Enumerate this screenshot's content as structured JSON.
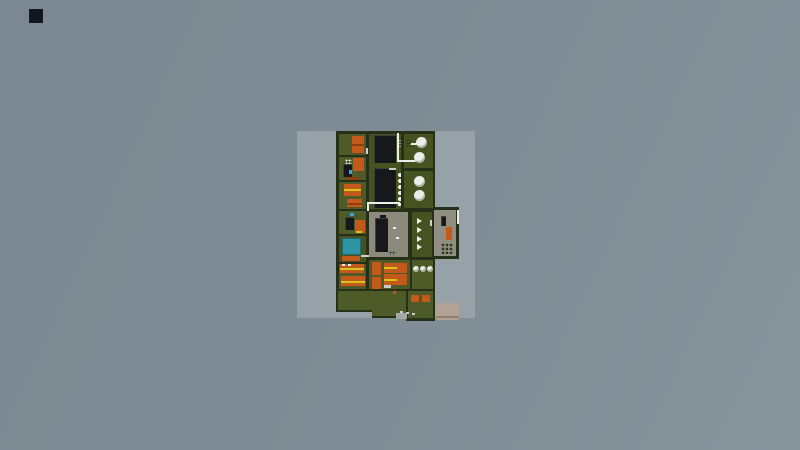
{
  "scene": {
    "description": "top-down pixel factory base map centered on light ground patch",
    "viewport": {
      "width": 800,
      "height": 450
    },
    "palette": {
      "patch": "#97a1a8",
      "marker": "#12161d",
      "wall": "#263018",
      "floor": "#4e5a28",
      "floorDark": "#46521f",
      "floorGray": "#8b8a7d",
      "floorAnnex": "#8f8e81",
      "orange": "#c35a1c",
      "orangeDark": "#8f3e10",
      "yellow": "#d9c41e",
      "black": "#17181b",
      "white": "#ecede9",
      "lightgray": "#c8ccc2",
      "doorLight": "#cfd2c8",
      "speckDark": "#2e3a1c",
      "teal": "#2f93a3",
      "tealDark": "#1d6a78",
      "blue": "#3aa7e0",
      "tan": "#b2a294",
      "tanDark": "#8e8172",
      "padGray": "#a3aaa5"
    },
    "elements": [
      {
        "n": "ground-patch",
        "t": "r",
        "x": 297,
        "y": 131,
        "w": 178,
        "h": 187,
        "c": "patch",
        "i": false
      },
      {
        "n": "corner-dark-square",
        "t": "r",
        "x": 29,
        "y": 9,
        "w": 14,
        "h": 14,
        "c": "marker",
        "i": false
      },
      {
        "n": "main-building-shell",
        "t": "r",
        "x": 336,
        "y": 131,
        "w": 99,
        "h": 162,
        "c": "wall",
        "i": false
      },
      {
        "n": "annex-shell",
        "t": "r",
        "x": 431,
        "y": 207,
        "w": 28,
        "h": 52,
        "c": "wall",
        "i": false
      },
      {
        "n": "yard-shell-a",
        "t": "r",
        "x": 336,
        "y": 289,
        "w": 38,
        "h": 23,
        "c": "wall",
        "i": false
      },
      {
        "n": "yard-shell-b",
        "t": "r",
        "x": 372,
        "y": 289,
        "w": 36,
        "h": 29,
        "c": "wall",
        "i": false
      },
      {
        "n": "yard-shell-c",
        "t": "r",
        "x": 406,
        "y": 289,
        "w": 29,
        "h": 32,
        "c": "wall",
        "i": false
      },
      {
        "n": "room-storage-1",
        "t": "r",
        "x": 339,
        "y": 134,
        "w": 27,
        "h": 21,
        "c": "floor",
        "i": true
      },
      {
        "n": "room-storage-2",
        "t": "r",
        "x": 339,
        "y": 157,
        "w": 27,
        "h": 23,
        "c": "floor",
        "i": true
      },
      {
        "n": "room-workshop-1",
        "t": "r",
        "x": 339,
        "y": 182,
        "w": 27,
        "h": 27,
        "c": "floor",
        "i": true
      },
      {
        "n": "room-workshop-2",
        "t": "r",
        "x": 339,
        "y": 211,
        "w": 27,
        "h": 23,
        "c": "floor",
        "i": true
      },
      {
        "n": "room-pool",
        "t": "r",
        "x": 339,
        "y": 236,
        "w": 27,
        "h": 26,
        "c": "floorDark",
        "i": true
      },
      {
        "n": "room-dorm-left",
        "t": "r",
        "x": 339,
        "y": 264,
        "w": 27,
        "h": 25,
        "c": "floor",
        "i": true
      },
      {
        "n": "hall-machines",
        "t": "r",
        "x": 369,
        "y": 134,
        "w": 32,
        "h": 75,
        "c": "floorDark",
        "i": true
      },
      {
        "n": "room-gray-hall",
        "t": "r",
        "x": 369,
        "y": 212,
        "w": 39,
        "h": 45,
        "c": "floorGray",
        "i": true
      },
      {
        "n": "room-conveyor",
        "t": "r",
        "x": 412,
        "y": 212,
        "w": 20,
        "h": 45,
        "c": "floorDark",
        "i": true
      },
      {
        "n": "room-dorm-mid",
        "t": "r",
        "x": 369,
        "y": 260,
        "w": 41,
        "h": 29,
        "c": "floor",
        "i": true
      },
      {
        "n": "room-tanks-1",
        "t": "r",
        "x": 404,
        "y": 134,
        "w": 29,
        "h": 34,
        "c": "floorDark",
        "i": true
      },
      {
        "n": "room-tanks-2",
        "t": "r",
        "x": 404,
        "y": 171,
        "w": 29,
        "h": 37,
        "c": "floorDark",
        "i": true
      },
      {
        "n": "room-tanks-3",
        "t": "r",
        "x": 412,
        "y": 260,
        "w": 21,
        "h": 29,
        "c": "floor",
        "i": true
      },
      {
        "n": "annex-floor",
        "t": "r",
        "x": 434,
        "y": 210,
        "w": 22,
        "h": 46,
        "c": "floorAnnex",
        "i": true
      },
      {
        "n": "yard-floor-a",
        "t": "r",
        "x": 338,
        "y": 291,
        "w": 36,
        "h": 19,
        "c": "floor",
        "i": true
      },
      {
        "n": "yard-floor-b",
        "t": "r",
        "x": 372,
        "y": 291,
        "w": 34,
        "h": 25,
        "c": "floor",
        "i": true
      },
      {
        "n": "yard-floor-c",
        "t": "r",
        "x": 408,
        "y": 291,
        "w": 25,
        "h": 27,
        "c": "floor",
        "i": true
      },
      {
        "n": "machine-orange-1",
        "t": "r",
        "x": 352,
        "y": 136,
        "w": 12,
        "h": 17,
        "c": "orange",
        "i": true
      },
      {
        "n": "machine-orange-1-line",
        "t": "r",
        "x": 352,
        "y": 144,
        "w": 12,
        "h": 2,
        "c": "orangeDark",
        "i": false
      },
      {
        "n": "crate-dots-white",
        "t": "d",
        "x": 345,
        "y": 159,
        "w": 7,
        "h": 8,
        "c": "white",
        "g": 3,
        "i": false
      },
      {
        "n": "machine-orange-2",
        "t": "r",
        "x": 353,
        "y": 158,
        "w": 11,
        "h": 13,
        "c": "orange",
        "i": true
      },
      {
        "n": "machine-dark-1",
        "t": "r",
        "x": 343,
        "y": 164,
        "w": 9,
        "h": 13,
        "c": "black",
        "cls": "mach",
        "i": true
      },
      {
        "n": "indicator-blue-1",
        "t": "r",
        "x": 349,
        "y": 170,
        "w": 3,
        "h": 4,
        "c": "blue",
        "i": false
      },
      {
        "n": "shelf-orange-1",
        "t": "r",
        "x": 348,
        "y": 177,
        "w": 12,
        "h": 3,
        "c": "orangeDark",
        "i": false
      },
      {
        "n": "machine-orange-3",
        "t": "r",
        "x": 344,
        "y": 184,
        "w": 17,
        "h": 12,
        "c": "orange",
        "i": true
      },
      {
        "n": "machine-orange-3-line",
        "t": "r",
        "x": 344,
        "y": 189,
        "w": 17,
        "h": 2,
        "c": "yellow",
        "i": false
      },
      {
        "n": "machine-orange-4",
        "t": "r",
        "x": 347,
        "y": 199,
        "w": 15,
        "h": 8,
        "c": "orange",
        "i": true
      },
      {
        "n": "machine-orange-4-line",
        "t": "r",
        "x": 347,
        "y": 203,
        "w": 15,
        "h": 2,
        "c": "orangeDark",
        "i": false
      },
      {
        "n": "indicator-blue-2",
        "t": "r",
        "x": 350,
        "y": 213,
        "w": 4,
        "h": 3,
        "c": "blue",
        "i": false
      },
      {
        "n": "machine-dark-2",
        "t": "r",
        "x": 345,
        "y": 217,
        "w": 9,
        "h": 13,
        "c": "black",
        "cls": "mach",
        "i": true
      },
      {
        "n": "machine-orange-5",
        "t": "r",
        "x": 355,
        "y": 220,
        "w": 10,
        "h": 13,
        "c": "orange",
        "i": true
      },
      {
        "n": "dash-yellow",
        "t": "r",
        "x": 356,
        "y": 231,
        "w": 6,
        "h": 2,
        "c": "yellow",
        "i": false
      },
      {
        "n": "water-pool",
        "t": "r",
        "x": 342,
        "y": 238,
        "w": 19,
        "h": 17,
        "c": "teal",
        "bd": "tealDark",
        "i": true
      },
      {
        "n": "shelf-orange-2",
        "t": "r",
        "x": 342,
        "y": 256,
        "w": 18,
        "h": 5,
        "c": "orange",
        "i": false
      },
      {
        "n": "bed-left-1",
        "t": "r",
        "x": 340,
        "y": 264,
        "w": 24,
        "h": 9,
        "c": "orange",
        "i": true
      },
      {
        "n": "bed-left-1-line",
        "t": "r",
        "x": 340,
        "y": 268,
        "w": 24,
        "h": 2,
        "c": "yellow",
        "i": false
      },
      {
        "n": "pillow-1",
        "t": "r",
        "x": 342,
        "y": 264,
        "w": 3,
        "h": 2,
        "c": "white",
        "i": false
      },
      {
        "n": "pillow-2",
        "t": "r",
        "x": 348,
        "y": 264,
        "w": 3,
        "h": 2,
        "c": "white",
        "i": false
      },
      {
        "n": "bed-left-2",
        "t": "r",
        "x": 341,
        "y": 276,
        "w": 24,
        "h": 10,
        "c": "orange",
        "i": true
      },
      {
        "n": "bed-left-2-line",
        "t": "r",
        "x": 341,
        "y": 281,
        "w": 24,
        "h": 2,
        "c": "yellow",
        "i": false
      },
      {
        "n": "machine-black-a",
        "t": "r",
        "x": 374,
        "y": 135,
        "w": 22,
        "h": 28,
        "c": "black",
        "cls": "mach",
        "i": true
      },
      {
        "n": "machine-black-b",
        "t": "r",
        "x": 374,
        "y": 168,
        "w": 22,
        "h": 40,
        "c": "black",
        "cls": "mach",
        "i": true
      },
      {
        "n": "machine-b-dash",
        "t": "r",
        "x": 389,
        "y": 168,
        "w": 7,
        "h": 2,
        "c": "lightgray",
        "i": false
      },
      {
        "n": "gauge-dots-1",
        "t": "d",
        "x": 397,
        "y": 139,
        "w": 4,
        "h": 10,
        "c": "white",
        "g": 3,
        "i": false
      },
      {
        "n": "gauge-dots-2",
        "t": "d",
        "x": 397,
        "y": 172,
        "w": 4,
        "h": 34,
        "c": "white",
        "g": 6,
        "i": false
      },
      {
        "n": "pipe-main-vertical",
        "t": "r",
        "x": 397,
        "y": 133,
        "w": 2,
        "h": 29,
        "c": "white",
        "i": false
      },
      {
        "n": "pipe-main-horizontal",
        "t": "r",
        "x": 397,
        "y": 160,
        "w": 21,
        "h": 2,
        "c": "white",
        "i": false
      },
      {
        "n": "pipe-tick",
        "t": "r",
        "x": 410,
        "y": 143,
        "w": 7,
        "h": 2,
        "c": "white",
        "i": false
      },
      {
        "n": "pipe-l-horizontal",
        "t": "r",
        "x": 367,
        "y": 202,
        "w": 33,
        "h": 2,
        "c": "white",
        "i": false
      },
      {
        "n": "pipe-l-vertical",
        "t": "r",
        "x": 367,
        "y": 202,
        "w": 2,
        "h": 9,
        "c": "white",
        "i": false
      },
      {
        "n": "machine-black-c",
        "t": "r",
        "x": 375,
        "y": 218,
        "w": 13,
        "h": 34,
        "c": "black",
        "cls": "mach",
        "i": true
      },
      {
        "n": "machine-c-cap",
        "t": "r",
        "x": 380,
        "y": 215,
        "w": 6,
        "h": 3,
        "c": "black",
        "i": false
      },
      {
        "n": "speck-white-1",
        "t": "r",
        "x": 393,
        "y": 227,
        "w": 3,
        "h": 2,
        "c": "white",
        "i": false
      },
      {
        "n": "speck-white-2",
        "t": "r",
        "x": 396,
        "y": 237,
        "w": 3,
        "h": 2,
        "c": "white",
        "i": false
      },
      {
        "n": "speck-dark-rows",
        "t": "d",
        "x": 389,
        "y": 251,
        "w": 7,
        "h": 4,
        "c": "speckDark",
        "g": 3,
        "i": false
      },
      {
        "n": "conveyor-arrow-1",
        "t": "a",
        "x": 417,
        "y": 218,
        "w": 5,
        "h": 6,
        "c": "white",
        "i": false
      },
      {
        "n": "conveyor-arrow-2",
        "t": "a",
        "x": 417,
        "y": 227,
        "w": 5,
        "h": 6,
        "c": "white",
        "i": false
      },
      {
        "n": "conveyor-arrow-3",
        "t": "a",
        "x": 417,
        "y": 236,
        "w": 5,
        "h": 6,
        "c": "white",
        "i": false
      },
      {
        "n": "conveyor-arrow-4",
        "t": "a",
        "x": 417,
        "y": 244,
        "w": 5,
        "h": 6,
        "c": "white",
        "i": false
      },
      {
        "n": "tank-1",
        "t": "c",
        "x": 416,
        "y": 137,
        "w": 11,
        "c": "white",
        "i": true
      },
      {
        "n": "tank-2",
        "t": "c",
        "x": 414,
        "y": 152,
        "w": 11,
        "c": "white",
        "i": true
      },
      {
        "n": "tank-3",
        "t": "c",
        "x": 414,
        "y": 176,
        "w": 11,
        "c": "white",
        "i": true
      },
      {
        "n": "tank-4",
        "t": "c",
        "x": 414,
        "y": 190,
        "w": 11,
        "c": "white",
        "i": true
      },
      {
        "n": "crate-dots-dark",
        "t": "d",
        "x": 406,
        "y": 139,
        "w": 5,
        "h": 8,
        "c": "speckDark",
        "g": 3,
        "i": false
      },
      {
        "n": "tank-small-1",
        "t": "c",
        "x": 413,
        "y": 266,
        "w": 6,
        "c": "white",
        "i": true
      },
      {
        "n": "tank-small-2",
        "t": "c",
        "x": 420,
        "y": 266,
        "w": 6,
        "c": "white",
        "i": true
      },
      {
        "n": "tank-small-3",
        "t": "c",
        "x": 427,
        "y": 266,
        "w": 6,
        "c": "white",
        "i": true
      },
      {
        "n": "bed-mid-vertical-1",
        "t": "r",
        "x": 372,
        "y": 262,
        "w": 9,
        "h": 13,
        "c": "orange",
        "i": true
      },
      {
        "n": "bed-mid-1",
        "t": "r",
        "x": 384,
        "y": 263,
        "w": 23,
        "h": 10,
        "c": "orange",
        "i": true
      },
      {
        "n": "bed-mid-1-line",
        "t": "r",
        "x": 384,
        "y": 267,
        "w": 13,
        "h": 2,
        "c": "yellow",
        "i": false
      },
      {
        "n": "bed-mid-vertical-2",
        "t": "r",
        "x": 372,
        "y": 277,
        "w": 9,
        "h": 12,
        "c": "orange",
        "i": true
      },
      {
        "n": "bed-mid-2",
        "t": "r",
        "x": 384,
        "y": 274,
        "w": 23,
        "h": 11,
        "c": "orange",
        "i": true
      },
      {
        "n": "bed-mid-2-line",
        "t": "r",
        "x": 384,
        "y": 279,
        "w": 13,
        "h": 2,
        "c": "yellow",
        "i": false
      },
      {
        "n": "locker-white",
        "t": "r",
        "x": 384,
        "y": 285,
        "w": 7,
        "h": 3,
        "c": "lightgray",
        "i": false
      },
      {
        "n": "annex-item-dark",
        "t": "r",
        "x": 441,
        "y": 216,
        "w": 5,
        "h": 10,
        "c": "black",
        "cls": "mach",
        "i": true
      },
      {
        "n": "annex-item-orange",
        "t": "r",
        "x": 446,
        "y": 227,
        "w": 6,
        "h": 13,
        "c": "orange",
        "i": true
      },
      {
        "n": "annex-pallet-dots",
        "t": "d",
        "x": 441,
        "y": 243,
        "w": 12,
        "h": 11,
        "c": "speckDark",
        "g": 4,
        "i": false
      },
      {
        "n": "annex-pipe",
        "t": "r",
        "x": 457,
        "y": 210,
        "w": 2,
        "h": 14,
        "c": "white",
        "i": false
      },
      {
        "n": "annex-door",
        "t": "r",
        "x": 430,
        "y": 220,
        "w": 2,
        "h": 6,
        "c": "doorLight",
        "i": false
      },
      {
        "n": "door-dash-1",
        "t": "r",
        "x": 366,
        "y": 148,
        "w": 2,
        "h": 6,
        "c": "doorLight",
        "i": false
      },
      {
        "n": "door-dash-2",
        "t": "r",
        "x": 361,
        "y": 255,
        "w": 8,
        "h": 2,
        "c": "doorLight",
        "i": false
      },
      {
        "n": "yard-orange-1",
        "t": "r",
        "x": 411,
        "y": 295,
        "w": 8,
        "h": 7,
        "c": "orange",
        "i": true
      },
      {
        "n": "yard-orange-2",
        "t": "r",
        "x": 422,
        "y": 295,
        "w": 8,
        "h": 7,
        "c": "orange",
        "i": true
      },
      {
        "n": "yard-orange-dot",
        "t": "r",
        "x": 393,
        "y": 291,
        "w": 3,
        "h": 3,
        "c": "orange",
        "i": false
      },
      {
        "n": "path-speck-1",
        "t": "r",
        "x": 400,
        "y": 311,
        "w": 3,
        "h": 2,
        "c": "lightgray",
        "i": false
      },
      {
        "n": "path-speck-2",
        "t": "r",
        "x": 406,
        "y": 312,
        "w": 3,
        "h": 2,
        "c": "lightgray",
        "i": false
      },
      {
        "n": "path-speck-3",
        "t": "r",
        "x": 412,
        "y": 313,
        "w": 3,
        "h": 2,
        "c": "lightgray",
        "i": false
      },
      {
        "n": "pad-small",
        "t": "r",
        "x": 396,
        "y": 313,
        "w": 11,
        "h": 6,
        "c": "padGray",
        "i": false
      },
      {
        "n": "pad-loading",
        "t": "r",
        "x": 436,
        "y": 303,
        "w": 23,
        "h": 17,
        "c": "tan",
        "i": true
      },
      {
        "n": "pad-loading-line",
        "t": "r",
        "x": 436,
        "y": 316,
        "w": 23,
        "h": 2,
        "c": "tanDark",
        "i": false
      }
    ]
  }
}
